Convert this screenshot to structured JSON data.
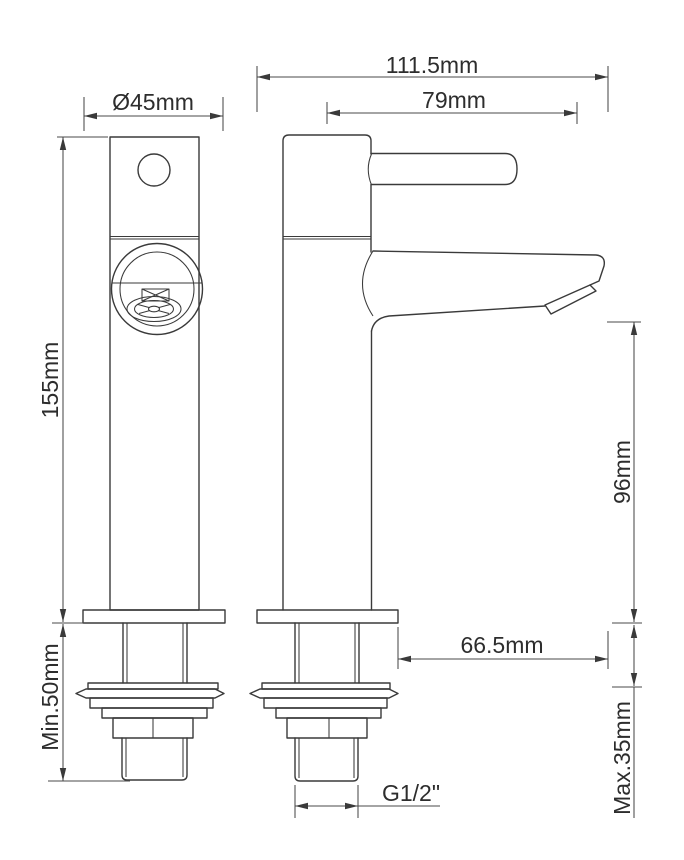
{
  "drawing": {
    "background_color": "#ffffff",
    "line_color": "#3a3a3a",
    "text_color": "#2d2d2d",
    "dimensions": {
      "base_diameter": "Ø45mm",
      "overall_depth": "111.5mm",
      "spout_reach_upper": "79mm",
      "height_above_deck": "155mm",
      "outlet_height": "96mm",
      "spout_reach_lower": "66.5mm",
      "min_clearance": "Min.50mm",
      "max_deck_thickness": "Max.35mm",
      "thread_size": "G1/2\""
    }
  }
}
